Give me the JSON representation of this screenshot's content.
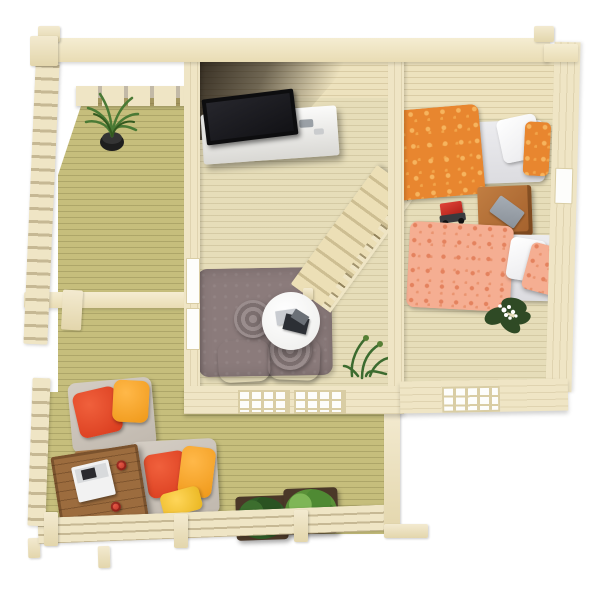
{
  "scene": {
    "description": "Top-down 3D render of a furnished wooden log cabin floor plan with side porch, living room, bedroom and front terrace",
    "background_color": "#ffffff",
    "wall_wood_color": "#efe5c5",
    "interior_floor_color": "#e6ddb9",
    "deck_floor_color": "#c6be7c"
  },
  "rooms": [
    {
      "id": "porch",
      "name": "Side porch",
      "floor": "green-stained deck boards",
      "items": [
        {
          "name": "potted-plant",
          "pot_color": "#222222",
          "foliage_color": "#4a7a35"
        },
        {
          "name": "left-railing",
          "color": "#efe5c5"
        },
        {
          "name": "pergola-beam",
          "color": "#efe5c5"
        },
        {
          "name": "slatted-half-wall",
          "color": "#efe5c5"
        }
      ]
    },
    {
      "id": "living-room",
      "name": "Living room",
      "floor": "pale pine planks",
      "items": [
        {
          "name": "flat-tv",
          "color": "#0d0d0f"
        },
        {
          "name": "tv-stand",
          "color": "#f4f3f1"
        },
        {
          "name": "staircase-with-handrail",
          "color": "#ecdfb6"
        },
        {
          "name": "area-rug",
          "color": "#8b7b7b"
        },
        {
          "name": "round-coffee-table",
          "color": "#ffffff",
          "contents": "magazines"
        },
        {
          "name": "grey-floor-cushions",
          "color": "#8e8585",
          "count": 4
        },
        {
          "name": "corner-plant",
          "foliage_color": "#3c6b2f"
        },
        {
          "name": "front-windows",
          "count": 2
        },
        {
          "name": "side-window-slots",
          "count": 2
        }
      ]
    },
    {
      "id": "bedroom",
      "name": "Bedroom",
      "floor": "pale pine planks",
      "items": [
        {
          "name": "single-bed-orange",
          "duvet_color": "#e8862f",
          "pillow_colors": [
            "#ffffff",
            "#e8862f"
          ]
        },
        {
          "name": "single-bed-salmon",
          "duvet_color": "#f5ae92",
          "pillow_colors": [
            "#ffffff",
            "#f5ae92"
          ]
        },
        {
          "name": "nightstand",
          "color": "#b4713a",
          "contents": "grey book"
        },
        {
          "name": "toy-truck",
          "color": "#c62828"
        },
        {
          "name": "flowering-plant",
          "foliage_color": "#2f4a25",
          "flower_color": "#ffffff"
        },
        {
          "name": "front-window",
          "count": 1
        },
        {
          "name": "side-window-slot",
          "count": 1
        }
      ]
    },
    {
      "id": "terrace",
      "name": "Front terrace",
      "floor": "green-stained deck boards",
      "items": [
        {
          "name": "lounge-chair-upper",
          "cushion_color": "#cbc3ba",
          "pillow_colors": [
            "#e34726",
            "#f5a329"
          ]
        },
        {
          "name": "lounge-chair-lower",
          "cushion_color": "#cbc3ba",
          "pillow_colors": [
            "#e34726",
            "#f5a329",
            "#f2c330"
          ]
        },
        {
          "name": "wooden-coffee-table",
          "color": "#9c6c3e",
          "contents": "white laptop and two red cups"
        },
        {
          "name": "planter-boxes",
          "count": 2,
          "foliage_colors": [
            "#2f5d27",
            "#61993f"
          ]
        },
        {
          "name": "deck-railing",
          "color": "#efe5c5"
        }
      ]
    }
  ]
}
